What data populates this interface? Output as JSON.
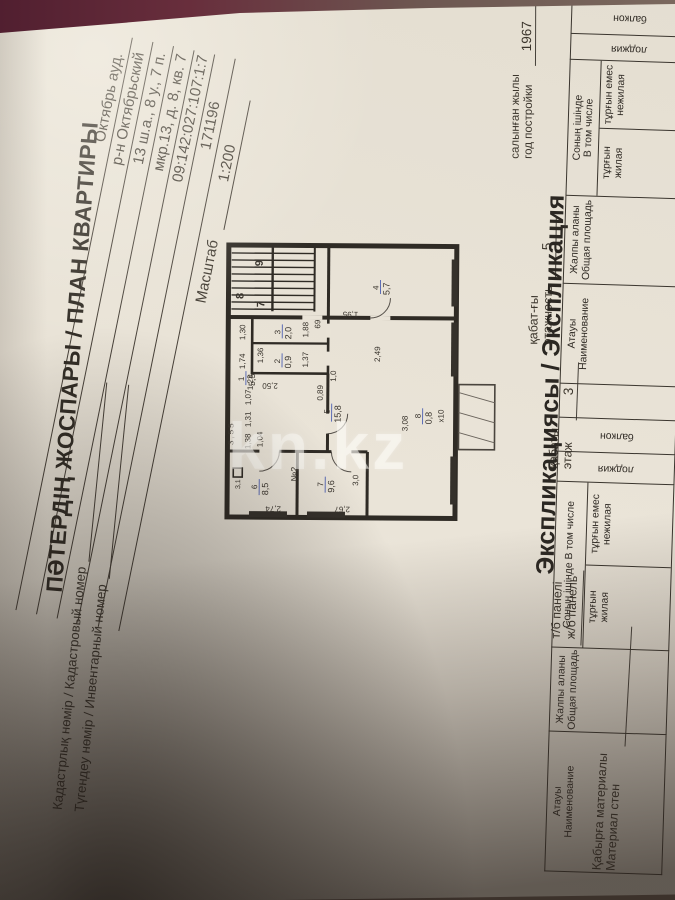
{
  "page": {
    "cadastral_label": "Кадастрлық нөмір / Кадастровый номер",
    "inventory_label": "Түгендеу нөмір / Инвентарный номер",
    "title": "ПӘТЕРДІҢ ЖОСПАРЫ / ПЛАН КВАРТИРЫ",
    "address_lines": [
      "Октябрь ауд.",
      "р-н Октябрьский",
      "13 ш.а., 8 у., 7 п.",
      "мкр.13, д. 8, кв. 7",
      "09:142:027:107:1:7",
      "171196"
    ],
    "scale_label": "Масштаб",
    "scale_value": "1:200",
    "wall_material_kk": "Қабырға материалы",
    "wall_material_ru": "Материал стен",
    "wall_material_value_kk": "т/б панелі",
    "wall_material_value_ru": "ж/б панель",
    "floor_kk": "қабаты",
    "floor_ru": "этаж",
    "floor_value": "3",
    "storeys_kk": "қабат-ғы",
    "storeys_ru": "этажность",
    "storeys_value": "5",
    "year_kk": "салынған жылы",
    "year_ru": "год постройки",
    "year_value": "1967",
    "explication_title": "Экспликациясы / Экспликация",
    "table": {
      "col_name_kk": "Атауы",
      "col_name_ru": "Наименование",
      "col_total_kk": "Жалпы аланы",
      "col_total_ru": "Общая площадь",
      "col_incl_kk": "Соның ішінде",
      "col_incl_ru": "В том числе",
      "col_living_kk": "тұрғын",
      "col_living_ru": "жилая",
      "col_nonliving_kk": "тұрғын емес",
      "col_nonliving_ru": "нежилая",
      "col_loggia": "лоджия",
      "col_balcony": "балкон"
    }
  },
  "plan": {
    "stair_numbers": [
      "8",
      "7",
      "9"
    ],
    "red_note": "№2",
    "rooms": [
      {
        "n": "1",
        "a": "5,5"
      },
      {
        "n": "2",
        "a": "0,9"
      },
      {
        "n": "3",
        "a": "2,0"
      },
      {
        "n": "4",
        "a": "5,7"
      },
      {
        "n": "5",
        "a": "15,8"
      },
      {
        "n": "6",
        "a": "8,5"
      },
      {
        "n": "7",
        "a": "9,6"
      },
      {
        "n": "8",
        "a": "0,8"
      }
    ],
    "dims": [
      "3,55",
      "1,38",
      "1,31",
      "1,07",
      "1,04",
      "1,23",
      "2,50",
      "1,74",
      "1,30",
      "1,37",
      "1,88",
      "69",
      "0,89",
      "1,0",
      "1,95",
      "2,49",
      "2,74",
      "2,67",
      "3,0",
      "3,08",
      "х10",
      "3,1",
      "1,36"
    ]
  },
  "watermark": "kn.kz",
  "colors": {
    "red": "#bb4234",
    "blue": "#3a50ae",
    "paper": "#eae4d8",
    "background_maroon": "#5d2434"
  }
}
